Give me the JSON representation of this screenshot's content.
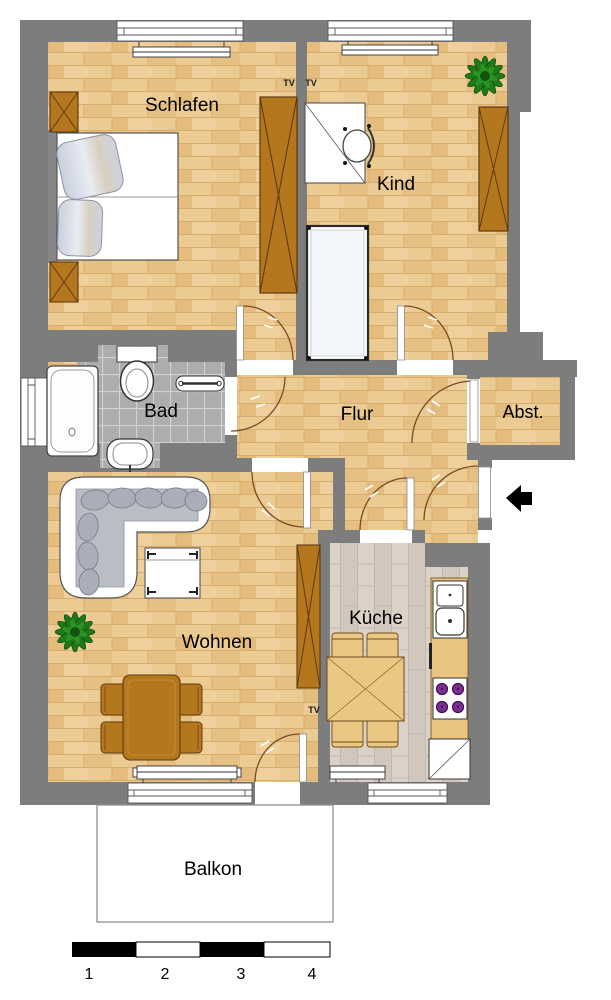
{
  "rooms": {
    "schlafen": "Schlafen",
    "kind": "Kind",
    "bad": "Bad",
    "flur": "Flur",
    "abst": "Abst.",
    "wohnen": "Wohnen",
    "kueche": "Küche",
    "balkon": "Balkon"
  },
  "annotations": {
    "tv": "TV"
  },
  "scale_bar": {
    "n1": "1",
    "n2": "2",
    "n3": "3",
    "n4": "4"
  },
  "colors": {
    "wall": "#7d7d7d",
    "wood_floor": "#eccb92",
    "kitchen_floor": "#d8d0c7",
    "bath_tile": "#ababab",
    "furniture_wood": "#b5771e",
    "kitchen_furniture": "#eac883",
    "counter": "#e8c47e",
    "sofa_cushion": "#b9bdc4",
    "stove_burner": "#7e2d93",
    "plant": "#1d7a17",
    "door_swing": "#7b4a28",
    "entry_arrow": "#000000"
  }
}
